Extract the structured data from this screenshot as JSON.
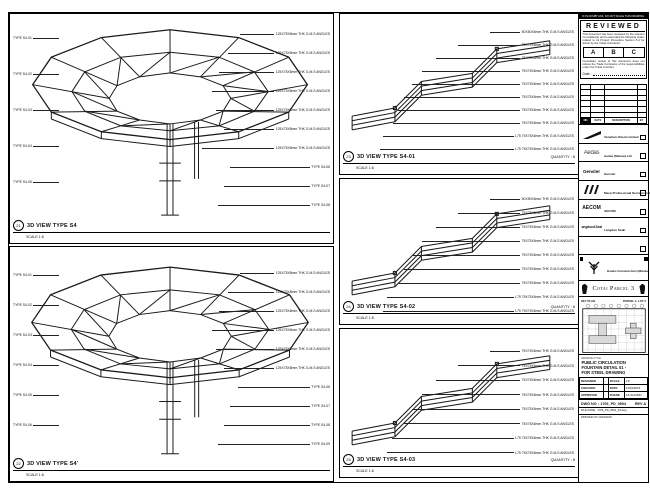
{
  "views": {
    "lt": {
      "no": "21",
      "title": "3D VIEW TYPE S4",
      "scale": "SCALE 1:8",
      "left": [
        "TYPE S4-01",
        "TYPE S4-02",
        "TYPE S4-03",
        "TYPE S4-04",
        "TYPE S4-05"
      ],
      "right": [
        "125X75X8mm THK G.M.S ANGLES",
        "125X75X8mm THK G.M.S ANGLES",
        "125X75X8mm THK G.M.S ANGLES",
        "125X75X8mm THK G.M.S ANGLES",
        "125X75X8mm THK G.M.S ANGLES",
        "125X75X8mm THK G.M.S ANGLES",
        "125X75X8mm THK G.M.S ANGLES",
        "TYPE S4-06",
        "TYPE S4-07",
        "TYPE S4-08"
      ]
    },
    "lb": {
      "no": "22",
      "title": "3D VIEW TYPE S4'",
      "scale": "SCALE 1:8",
      "left": [
        "TYPE S4-01",
        "TYPE S4-02",
        "TYPE S4-03",
        "TYPE S4-04",
        "TYPE S4-05",
        "TYPE S4-06"
      ],
      "right": [
        "125X75X8mm THK G.M.S ANGLES",
        "125X75X8mm THK G.M.S ANGLES",
        "125X75X8mm THK G.M.S ANGLES",
        "125X75X8mm THK G.M.S ANGLES",
        "125X75X8mm THK G.M.S ANGLES",
        "125X75X8mm THK G.M.S ANGLES",
        "TYPE S4-06",
        "TYPE S4-07",
        "TYPE S4-08",
        "TYPE S4-09"
      ]
    },
    "m1": {
      "no": "23",
      "title": "3D VIEW TYPE S4-01",
      "scale": "SCALE 1:8",
      "quantity": "QUANTITY : 8",
      "right": [
        "50X50X6mm THK G.M.S ANGLES",
        "75X75X6mm THK G.M.S ANGLES",
        "75X75X6mm THK G.M.S ANGLES",
        "75X75X6mm THK G.M.S ANGLES",
        "75X75X6mm THK G.M.S ANGLES",
        "75X75X6mm THK G.M.S ANGLES",
        "75X75X6mm THK G.M.S ANGLES",
        "75X75X6mm THK G.M.S ANGLES",
        "L75 75X75X6mm THK G.M.S ANGLES",
        "L75 75X75X6mm THK G.M.S ANGLES"
      ]
    },
    "m2": {
      "no": "24",
      "title": "3D VIEW TYPE S4-02",
      "scale": "SCALE 1:8",
      "quantity": "QUANTITY : 8",
      "right": [
        "50X50X6mm THK G.M.S ANGLES",
        "75X75X6mm THK G.M.S ANGLES",
        "75X75X6mm THK G.M.S ANGLES",
        "75X75X6mm THK G.M.S ANGLES",
        "75X75X6mm THK G.M.S ANGLES",
        "75X75X6mm THK G.M.S ANGLES",
        "75X75X6mm THK G.M.S ANGLES",
        "L75 75X75X6mm THK G.M.S ANGLES",
        "L75 75X75X6mm THK G.M.S ANGLES"
      ]
    },
    "m3": {
      "no": "25",
      "title": "3D VIEW TYPE S4-03",
      "scale": "SCALE 1:8",
      "quantity": "QUANTITY : 8",
      "right": [
        "75X75X6mm THK G.M.S ANGLES",
        "75X75X6mm THK G.M.S ANGLES",
        "75X75X6mm THK G.M.S ANGLES",
        "75X75X6mm THK G.M.S ANGLES",
        "75X75X6mm THK G.M.S ANGLES",
        "75X75X6mm THK G.M.S ANGLES",
        "L75 75X75X6mm THK G.M.S ANGLES",
        "L75 75X75X6mm THK G.M.S ANGLES"
      ]
    }
  },
  "titleblock": {
    "top_strip": "IF IN DOUBT ASK. DO NOT SCALE THIS DRAWING.",
    "reviewed": {
      "heading": "REVIEWED",
      "para1": "This document has been reviewed by the relevant Consultant(s) and is accorded the following status related to its Project Procedure Section 5.4 for action by the Trade Contractor.",
      "grades": [
        "A",
        "B",
        "C"
      ],
      "para2": "Consultant review of this document does not relieve the Trade Contractor of his responsibilities under the Trade Contract.",
      "date_label": "Date :"
    },
    "rev_header": [
      "NO.",
      "DATE",
      "DESCRIPTION",
      "BY"
    ],
    "parties": [
      {
        "mark": "",
        "name": "Venetian Orient Limited"
      },
      {
        "mark": "Aedas",
        "name": "Aedas (Macau) Ltd."
      },
      {
        "mark": "Gensler",
        "name": "Gensler"
      },
      {
        "mark": "",
        "name": "Meca Professional Services Ltd."
      },
      {
        "mark": "AECOM",
        "name": "AECOM"
      },
      {
        "mark": "Langdon&Seah",
        "name": "Langdon Seah"
      },
      {
        "mark": "",
        "name": ""
      }
    ],
    "contractor": {
      "name": "Hsabo Construction (Macau) CO., LTD."
    },
    "project": "Cotai Parcel 3",
    "keyplan": {
      "label": "KEY PLAN",
      "lot": "PARCEL 1, LOT 2"
    },
    "drawing_title_label": "DRAWING TITLE",
    "drawing_title": [
      "PUBLIC CIRCULATION",
      "FOUNTAIN DETAIL 01 -",
      "FOR STEEL DRAWING"
    ],
    "info": {
      "designed_l": "DESIGNED",
      "designed_v": "-",
      "scale_l": "SCALE",
      "scale_v": "1:8",
      "checked_l": "CHECKED",
      "checked_v": "-",
      "date_l": "DATE",
      "date_v": "13/04/2015",
      "approved_l": "APPROVED",
      "approved_v": "-",
      "phase_l": "PHASE",
      "phase_v": "AS SHOWN"
    },
    "dwg_label": "DWG NO :",
    "dwg_no": "1706_PD_0504",
    "rev": "REV A",
    "file_rows": [
      "FILE NAME : 1706_PD_0504_S4.dwg",
      "PRINTED ON 13/04/2015"
    ]
  }
}
